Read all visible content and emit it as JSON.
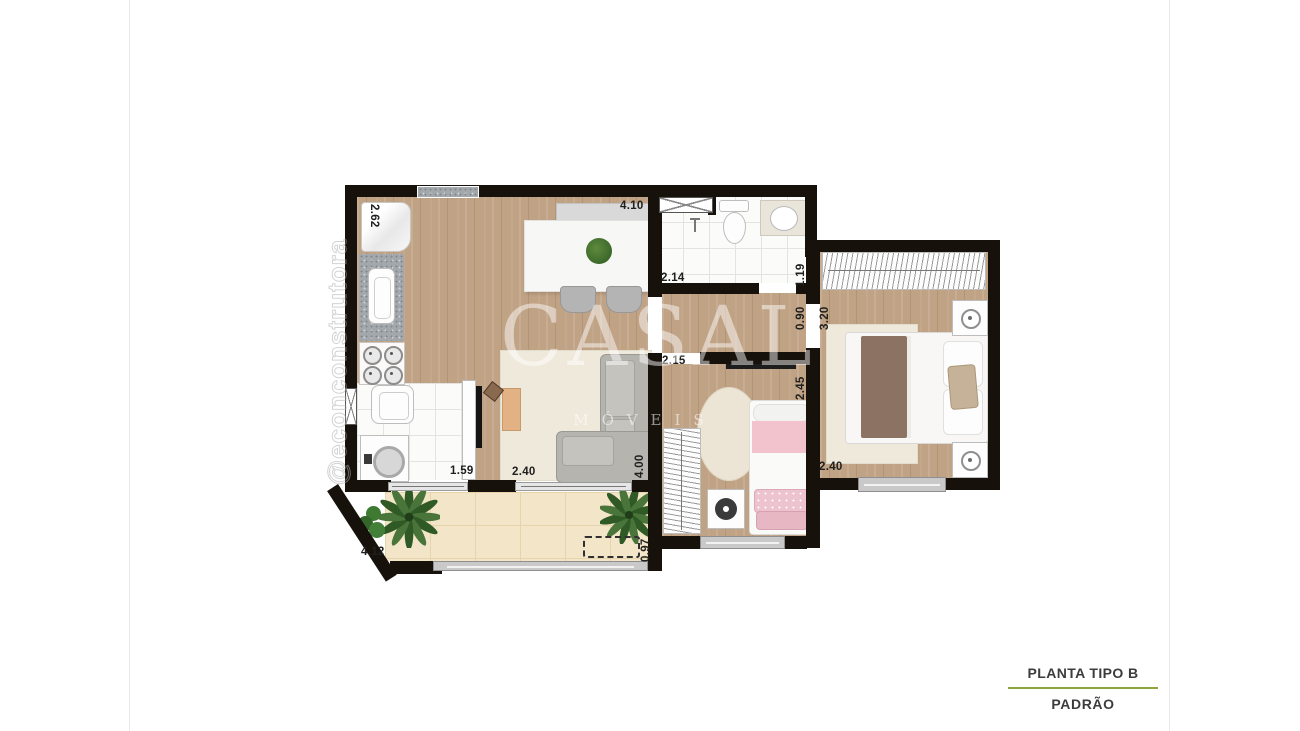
{
  "watermark": {
    "brand": "CASAL",
    "brand_subtitle": "MÓVEIS",
    "handle": "@econconstrutora"
  },
  "title_block": {
    "title": "PLANTA TIPO B",
    "subtitle": "PADRÃO"
  },
  "dimension_labels": {
    "kitchen_side": "2.62",
    "dining_top": "4.10",
    "bathroom_width": "2.14",
    "bathroom_side": "1.19",
    "hall_width": "0.90",
    "master_bedroom_side": "3.20",
    "bedroom2_top": "2.15",
    "bedroom2_side": "2.45",
    "master_bedroom_width": "2.40",
    "living_side": "4.00",
    "living_width": "2.40",
    "laundry_opening": "1.59",
    "balcony_width": "4.12",
    "balcony_side": "0.97"
  },
  "colors": {
    "wall": "#17110b",
    "wood_floor": "#c0a285",
    "white_tile": "#fbfbfa",
    "balcony_tile": "#f3e5c7",
    "accent_line": "#8ea43e"
  }
}
